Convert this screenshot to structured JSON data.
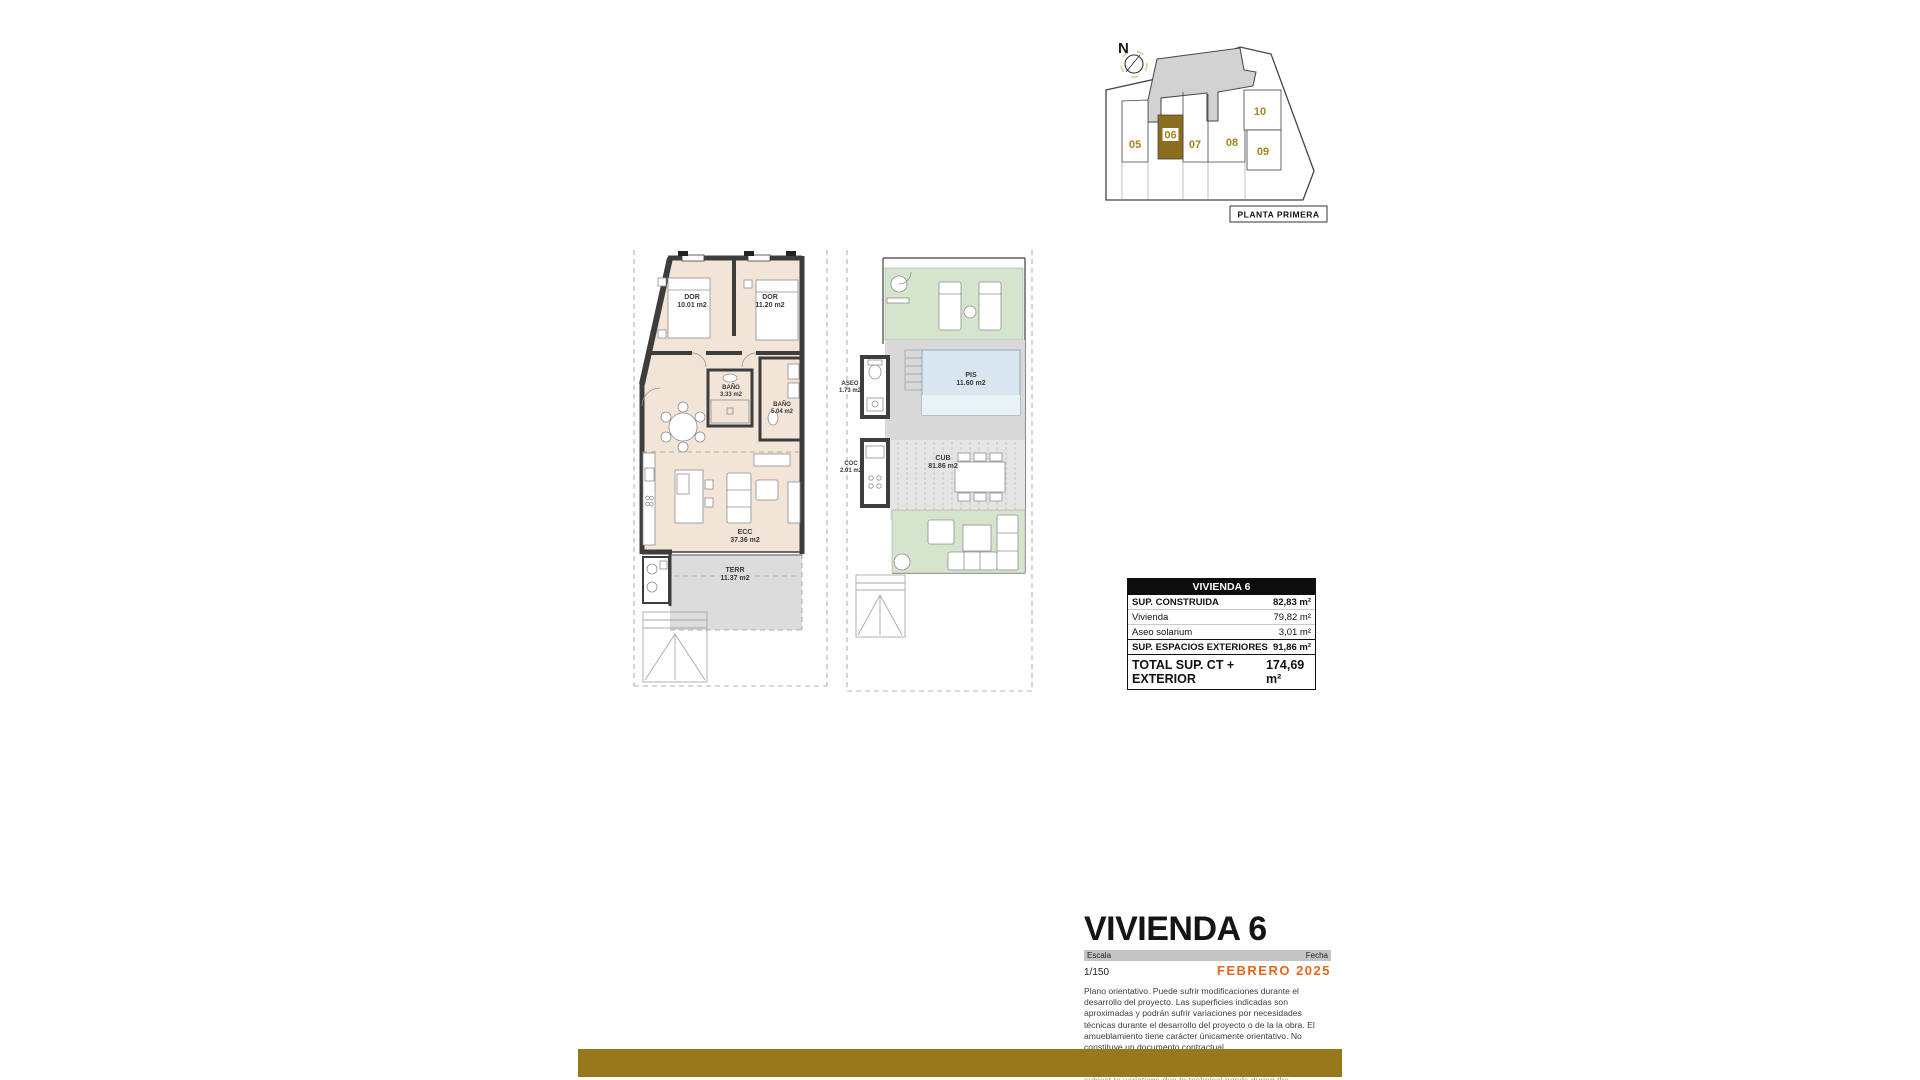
{
  "site_plan": {
    "compass": "N",
    "caption": "PLANTA PRIMERA",
    "units": {
      "u05": "05",
      "u06": "06",
      "u07": "07",
      "u08": "08",
      "u09": "09",
      "u10": "10"
    },
    "highlighted_unit": "06"
  },
  "plans": {
    "main": {
      "rooms": {
        "dor1": {
          "name": "DOR",
          "area": "10.01 m2"
        },
        "dor2": {
          "name": "DOR",
          "area": "11.20 m2"
        },
        "bano1": {
          "name": "BAÑO",
          "area": "3.33 m2"
        },
        "bano2": {
          "name": "BAÑO",
          "area": "5.04 m2"
        },
        "ecc": {
          "name": "ECC",
          "area": "37.36 m2"
        },
        "terr": {
          "name": "TERR",
          "area": "11.37 m2"
        }
      }
    },
    "solarium": {
      "rooms": {
        "aseo": {
          "name": "ASEO",
          "area": "1.73 m2"
        },
        "pis": {
          "name": "PIS",
          "area": "11.60 m2"
        },
        "coc": {
          "name": "COC",
          "area": "2.01 m2"
        },
        "cub": {
          "name": "CUB",
          "area": "81.86 m2"
        }
      }
    }
  },
  "summary_table": {
    "header": "VIVIENDA 6",
    "rows": [
      {
        "label": "SUP. CONSTRUIDA",
        "value": "82,83 m²"
      },
      {
        "label": "Vivienda",
        "value": "79,82 m²"
      },
      {
        "label": "Aseo solarium",
        "value": "3,01 m²"
      },
      {
        "label": "SUP. ESPACIOS EXTERIORES",
        "value": "91,86 m²"
      },
      {
        "label": "TOTAL SUP. CT + EXTERIOR",
        "value": "174,69 m²"
      }
    ]
  },
  "title_block": {
    "title": "VIVIENDA 6",
    "scale_label": "Escala",
    "scale_value": "1/150",
    "date_label": "Fecha",
    "date_value": "FEBRERO 2025",
    "disclaimer_es": "Plano orientativo. Puede sufrir modificaciones durante el desarrollo del proyecto. Las superficies indicadas son aproximadas y podrán sufrir variaciones por necesidades técnicas durante el desarrollo del proyecto o de la la obra. El amueblamiento tiene carácter únicamente orientativo. No constituye un documento contractual.",
    "disclaimer_en": "Indicative plan. It may be modified during the development of the project. The areas indicated are approximate and may be subject to variations due to technical needs during the development of the project or the work. The furnishings are for guidance only. It does not constitute a contractual document."
  },
  "colors": {
    "accent_gold": "#97791b",
    "date_orange": "#e5671d",
    "floor_beige": "#f2e4d6",
    "wall_dark": "#3d3d3d",
    "terrace_gray": "#dcdcdc",
    "lawn_green": "#d5e4cc",
    "pool_blue": "#d7e6ef",
    "site_highlight": "#8a6d1d",
    "unit_number_gold": "#a3841f"
  }
}
